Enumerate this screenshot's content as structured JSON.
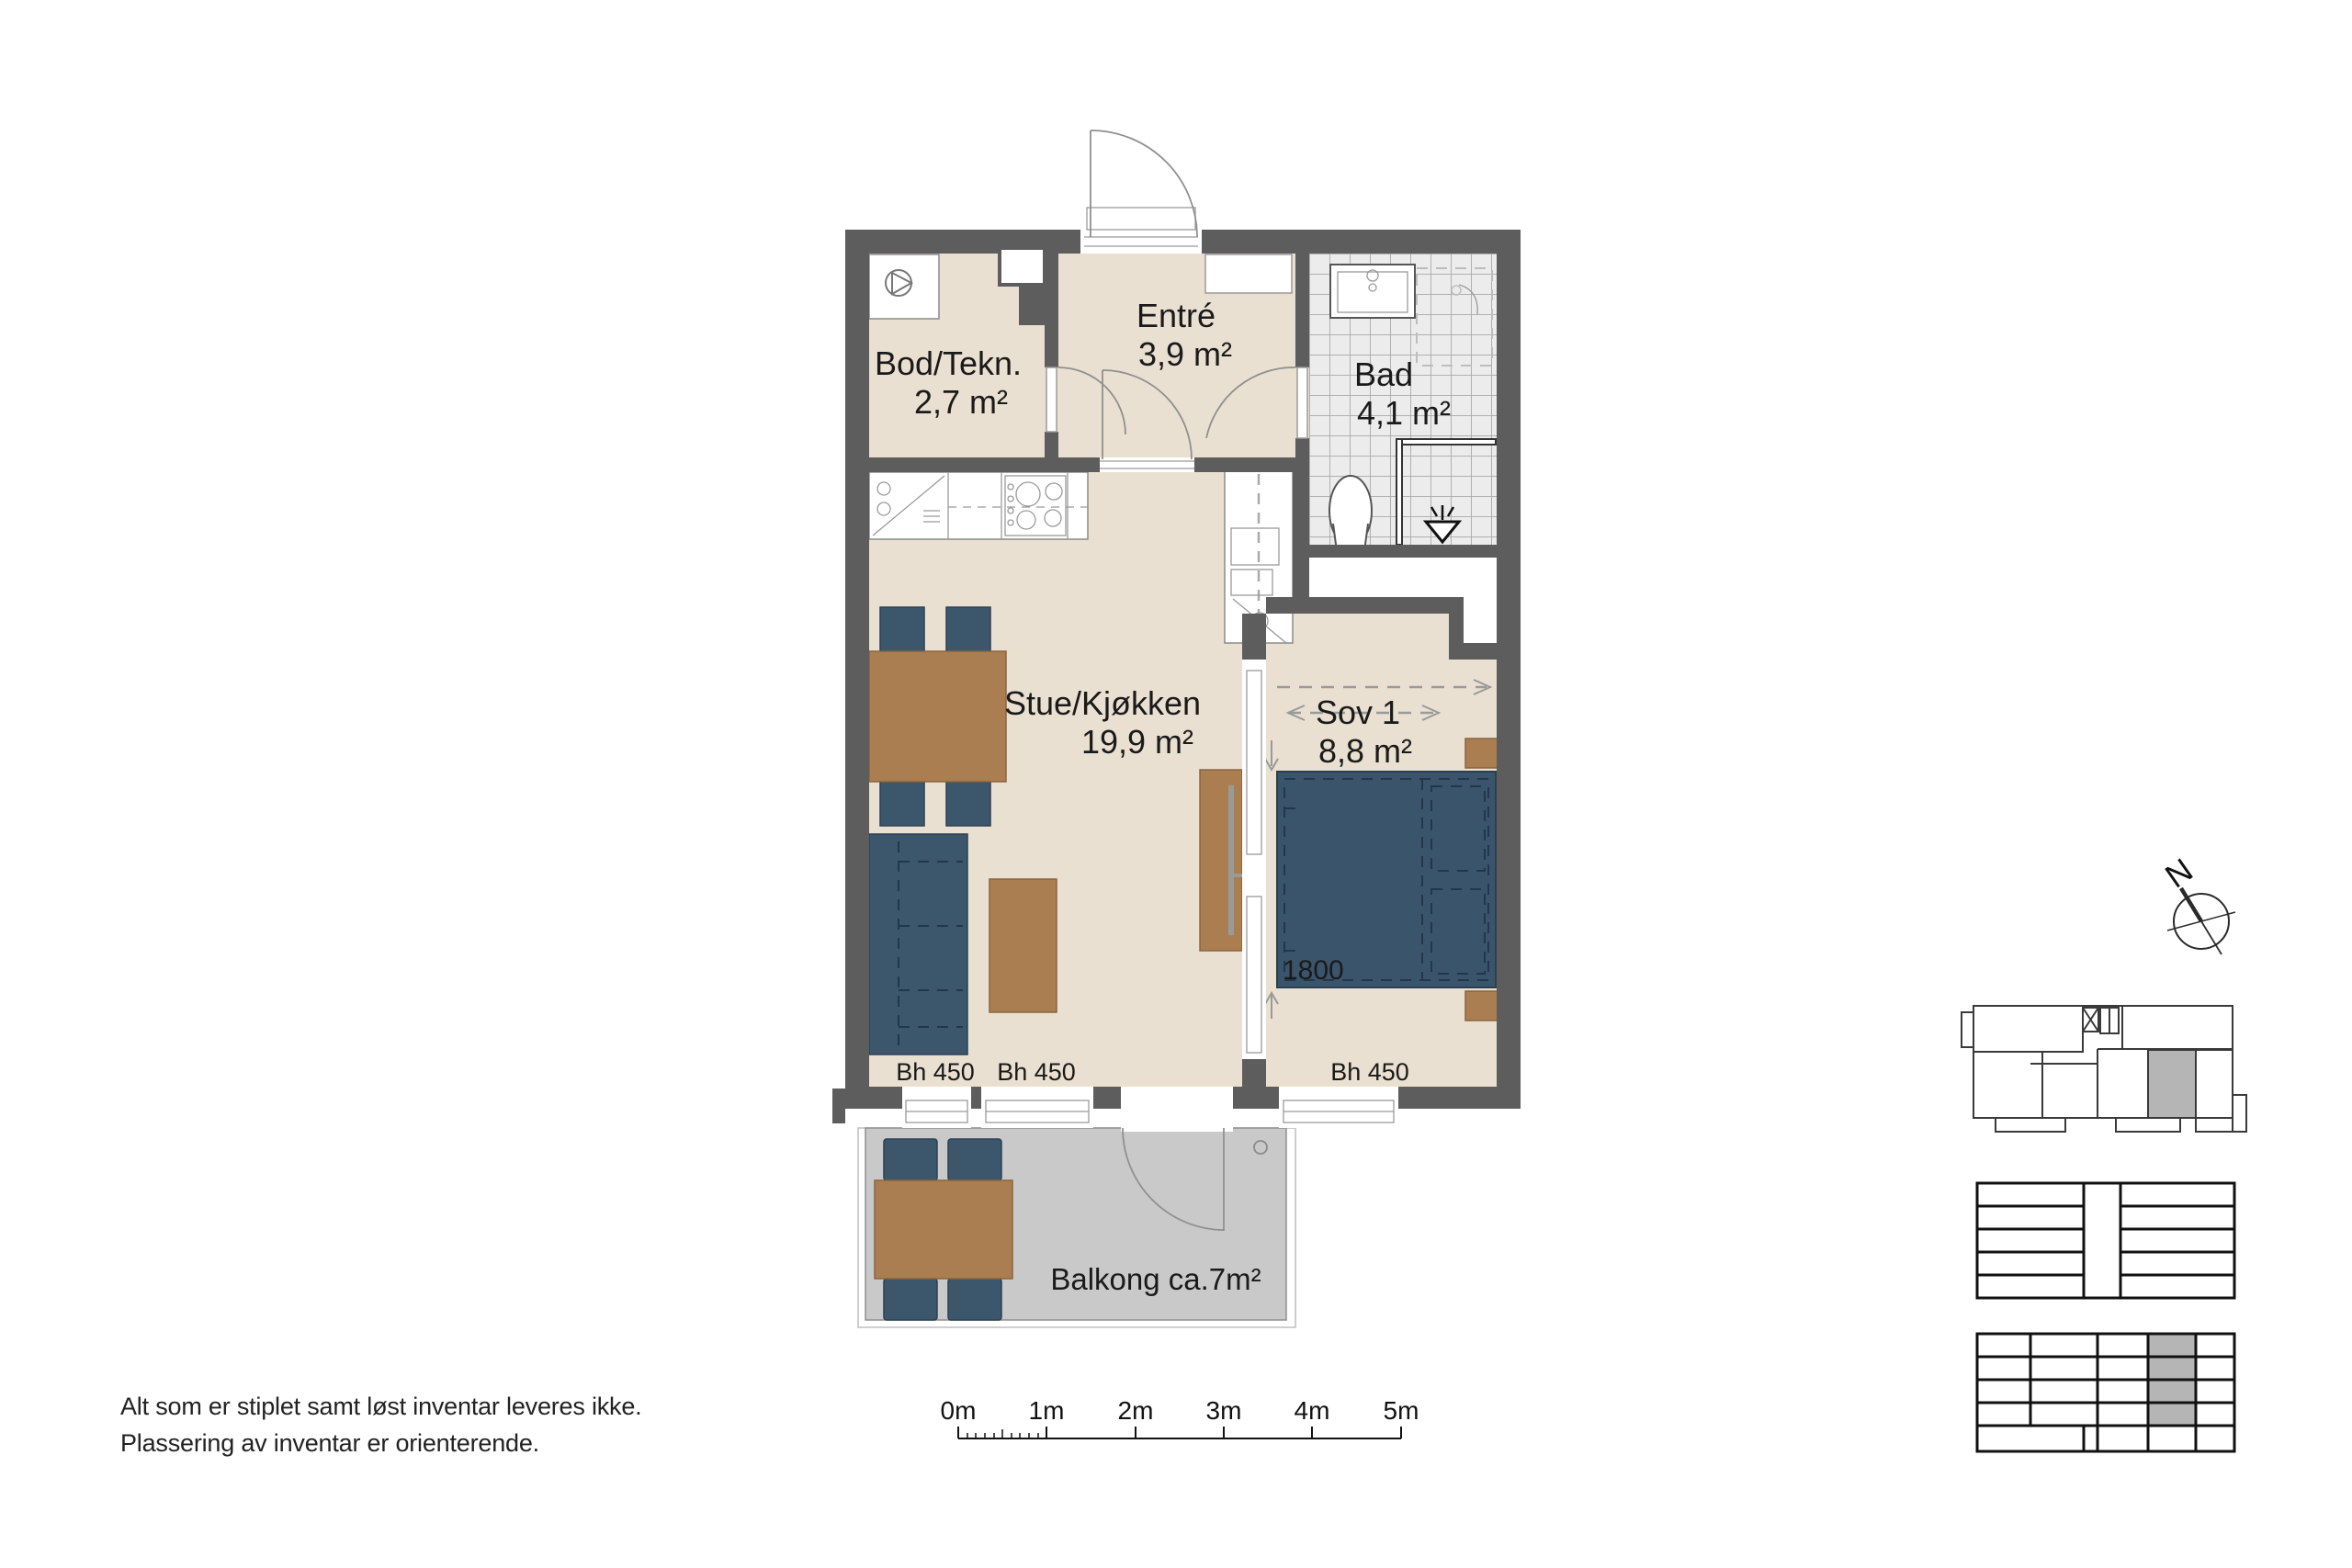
{
  "plan": {
    "rooms": {
      "bod": {
        "name": "Bod/Tekn.",
        "area": "2,7 m²"
      },
      "entre": {
        "name": "Entré",
        "area": "3,9 m²"
      },
      "bad": {
        "name": "Bad",
        "area": "4,1 m²"
      },
      "stue": {
        "name": "Stue/Kjøkken",
        "area": "19,9 m²"
      },
      "sov": {
        "name": "Sov 1",
        "area": "8,8 m²"
      },
      "balkong": {
        "label": "Balkong ca.7m²"
      }
    },
    "annotations": {
      "bh_450_left": "Bh 450",
      "bh_450_mid": "Bh 450",
      "bh_450_right": "Bh 450",
      "bed_width": "1800"
    }
  },
  "notes": {
    "line1": "Alt som er stiplet samt løst inventar leveres ikke.",
    "line2": "Plassering av inventar er orienterende."
  },
  "scale_bar": {
    "labels": [
      "0m",
      "1m",
      "2m",
      "3m",
      "4m",
      "5m"
    ]
  },
  "compass": {
    "north_label": "N"
  },
  "colors": {
    "wall": "#5d5d5d",
    "floor": "#e9e0d1",
    "tile": "#ececec",
    "balcony": "#c9c9c9",
    "furniture_blue": "#3c566c",
    "furniture_wood": "#ab7e51",
    "key_plan_highlight": "#b5b5b5"
  }
}
